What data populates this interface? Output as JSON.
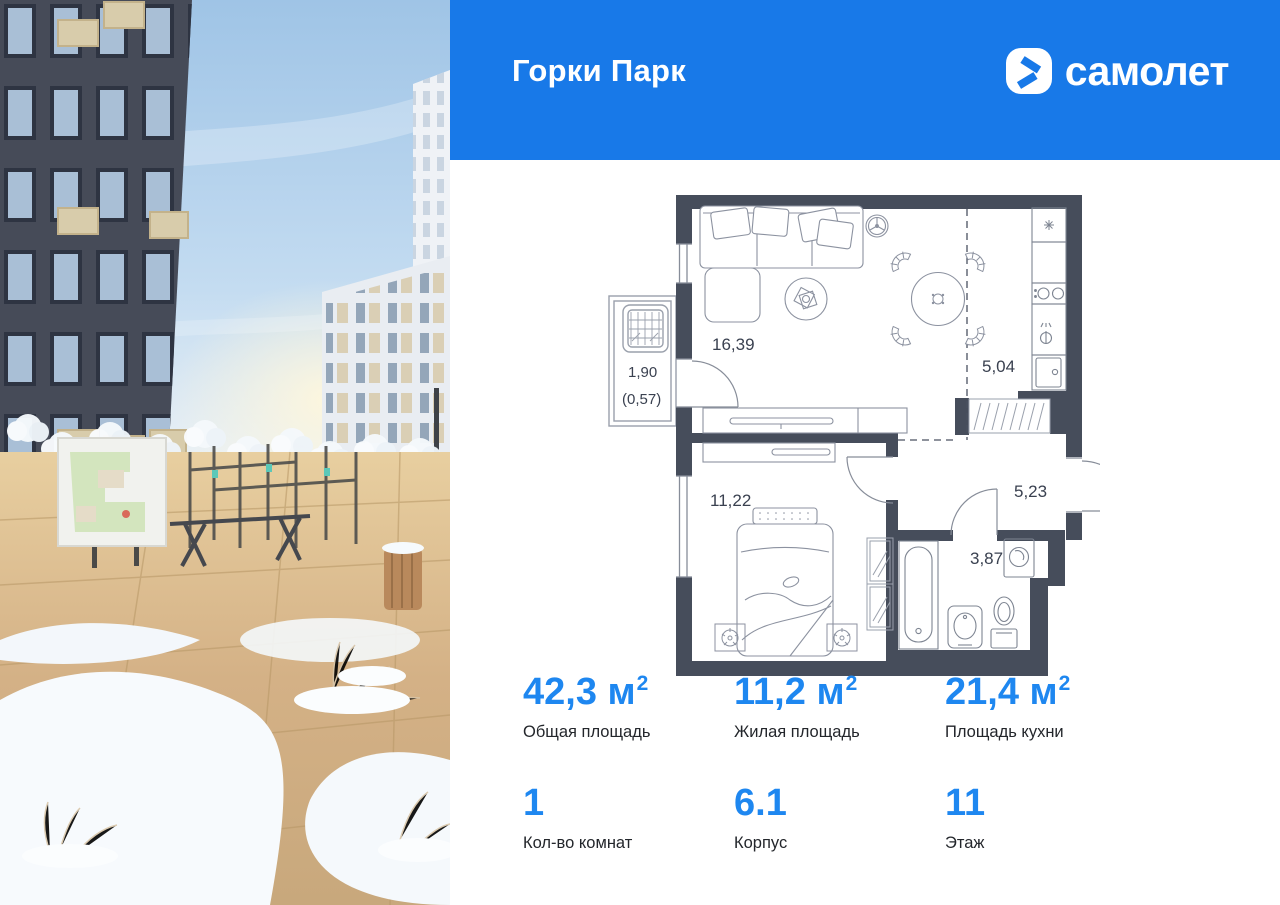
{
  "header": {
    "title": "Горки Парк",
    "brand": "самолет"
  },
  "plan": {
    "living": "16,39",
    "kitchen": "5,04",
    "balcony_len": "1,90",
    "balcony_area": "(0,57)",
    "bedroom": "11,22",
    "hallway": "5,23",
    "bathroom": "3,87"
  },
  "stats": {
    "areas": [
      {
        "value": "42,3",
        "unit": "м",
        "power": "2",
        "label": "Общая площадь"
      },
      {
        "value": "11,2",
        "unit": "м",
        "power": "2",
        "label": "Жилая площадь"
      },
      {
        "value": "21,4",
        "unit": "м",
        "power": "2",
        "label": "Площадь кухни"
      }
    ],
    "details": [
      {
        "value": "1",
        "label": "Кол-во комнат"
      },
      {
        "value": "6.1",
        "label": "Корпус"
      },
      {
        "value": "11",
        "label": "Этаж"
      }
    ]
  },
  "colors": {
    "brand_blue": "#1879E8",
    "accent_blue": "#1E87F0",
    "wall": "#464D5B"
  }
}
